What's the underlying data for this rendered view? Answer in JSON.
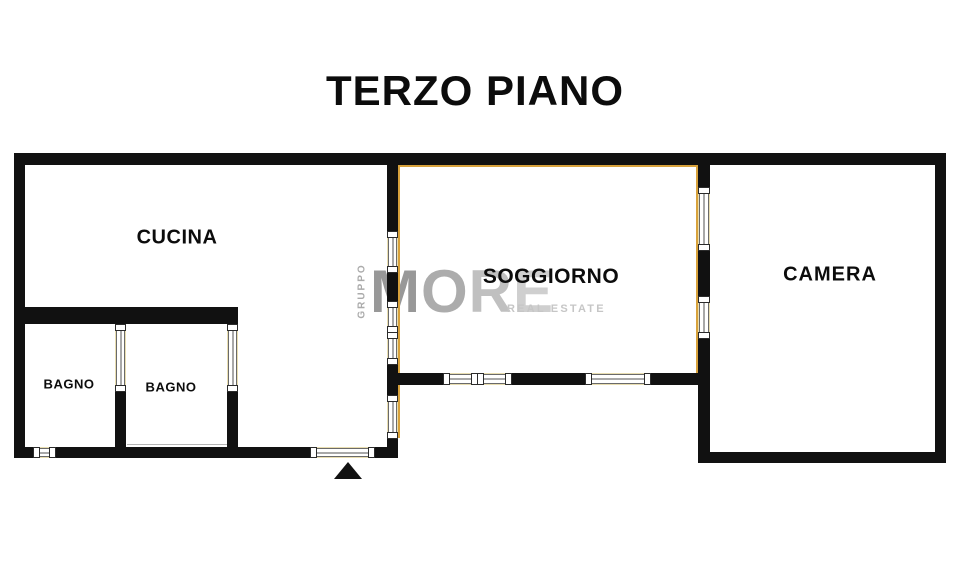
{
  "title": "TERZO PIANO",
  "rooms": {
    "cucina": {
      "label": "CUCINA"
    },
    "soggiorno": {
      "label": "SOGGIORNO"
    },
    "camera": {
      "label": "CAMERA"
    },
    "bagno_left": {
      "label": "BAGNO"
    },
    "bagno_right": {
      "label": "BAGNO"
    }
  },
  "watermark": {
    "vertical_text": "GRUPPO",
    "logo_letters": [
      "M",
      "O",
      "R",
      "E"
    ],
    "subtitle": "REAL ESTATE"
  },
  "entrance_marker": "up-triangle",
  "colors": {
    "wall": "#111111",
    "room_accent_outline": "#d8a23c",
    "window_frame_tint": "#e8ddb0",
    "watermark_gray": "#bdbdbd",
    "background": "#ffffff"
  }
}
